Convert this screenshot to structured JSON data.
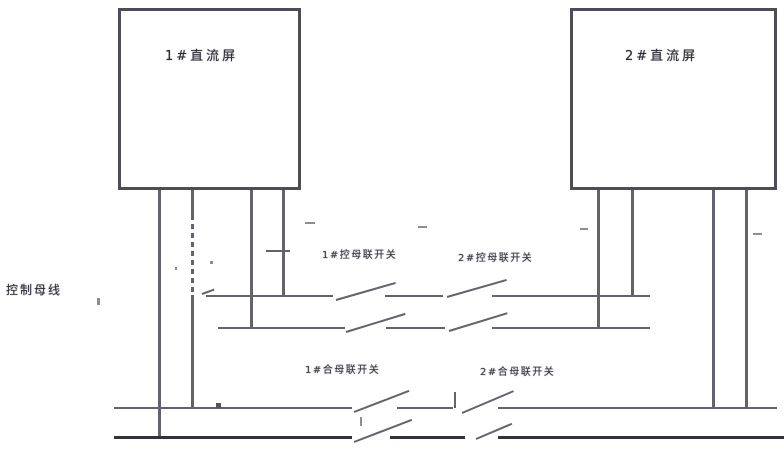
{
  "diagram": {
    "boxes": [
      {
        "label": "1#直流屏"
      },
      {
        "label": "2#直流屏"
      }
    ],
    "bus_label": "控制母线",
    "switch_labels": {
      "ctrl_left": "1#控母联开关",
      "ctrl_right": "2#控母联开关",
      "close_left": "1#合母联开关",
      "close_right": "2#合母联开关"
    },
    "colors": {
      "wire": "#63636b",
      "dark_wire": "#32323a",
      "text": "#3a3a44"
    }
  }
}
